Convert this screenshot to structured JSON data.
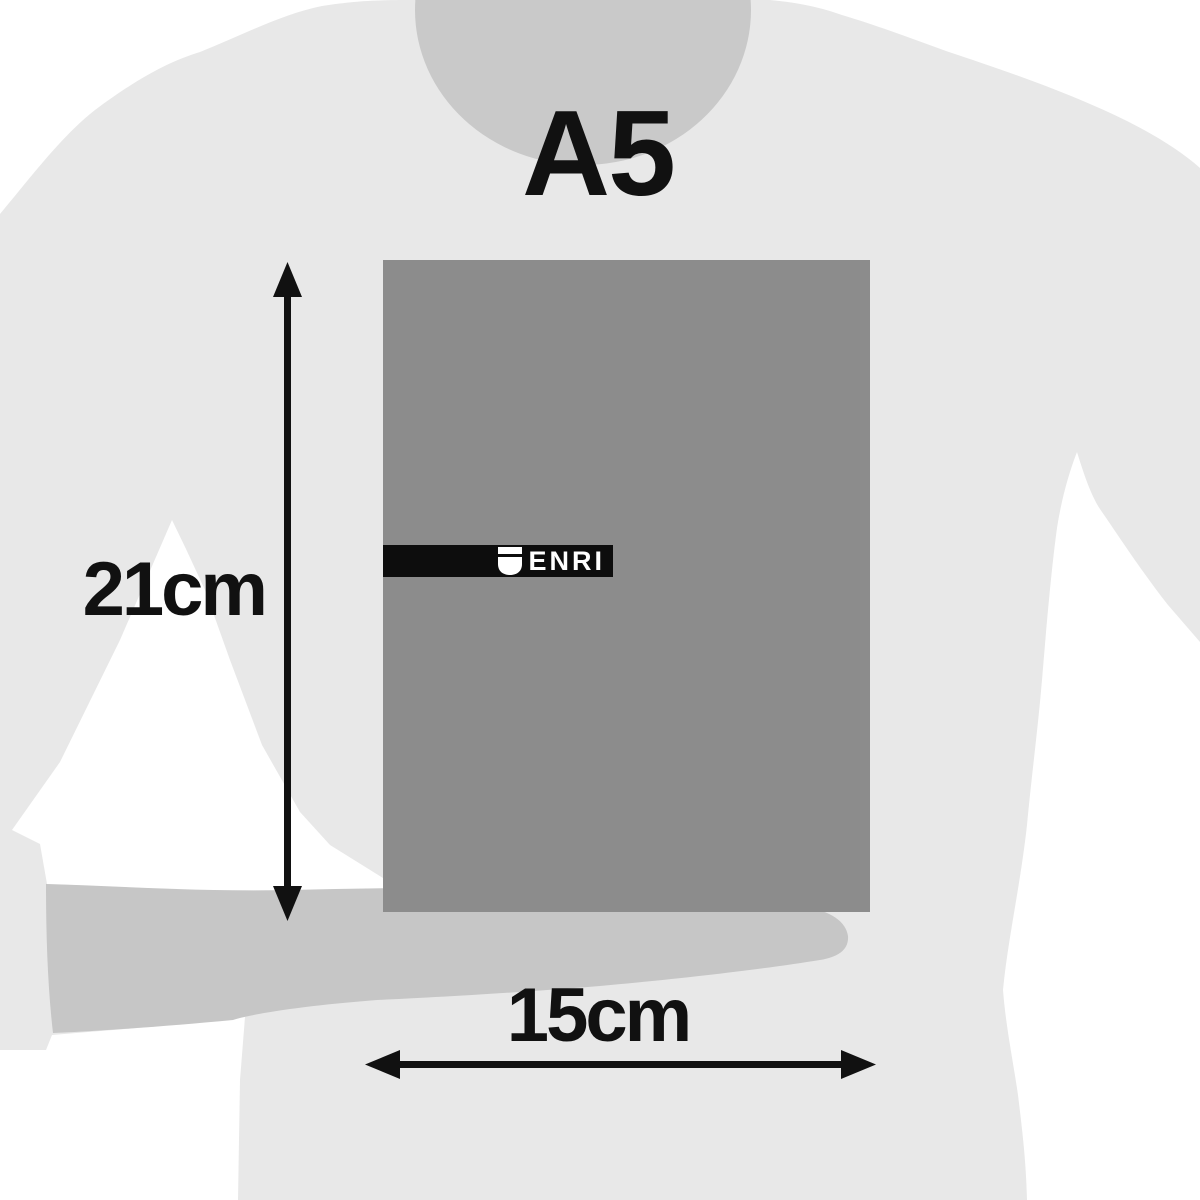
{
  "product": {
    "size_title": "A5",
    "brand": "ENRI",
    "dimensions": {
      "height_label": "21cm",
      "width_label": "15cm"
    }
  },
  "icons": {
    "brand_logo": "shield-icon"
  },
  "colors": {
    "background": "#ffffff",
    "body": "#e8e8e8",
    "head_shadow": "#c9c9c9",
    "forearm": "#c6c6c6",
    "notebook": "#8c8c8c",
    "band": "#0d0d0d",
    "logo_text": "#ffffff",
    "annotation": "#111111"
  }
}
